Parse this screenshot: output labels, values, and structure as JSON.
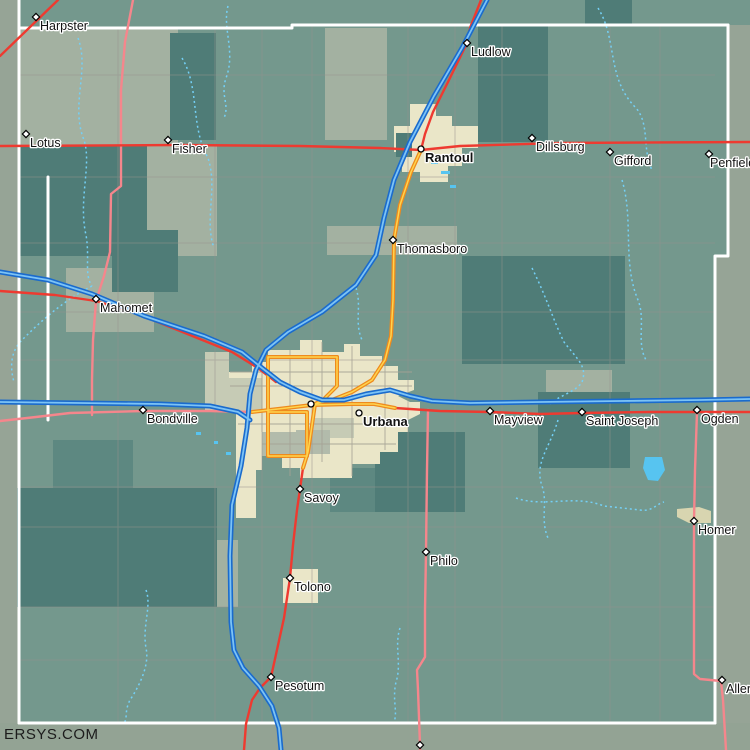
{
  "canvas": {
    "w": 750,
    "h": 750
  },
  "watermark": "ERSYS.COM",
  "palette": {
    "base": "#74988d",
    "dark": "#4f7c77",
    "mediumDark": "#5d8881",
    "light": "#a3b1a1",
    "lighter": "#c6cbb5",
    "graypatch": "#b2bbab",
    "beige": "#eae6c8",
    "khaki": "#d8d5b0",
    "outside": "#96a496",
    "band": "#93a394",
    "water": "#57c4f0",
    "stream": "#74d0f6",
    "grid": "#97928e",
    "citygrid": "#a5a295",
    "roadWhite": "#ffffff",
    "roadPink": "#f5868c",
    "roadRed": "#ee3a30",
    "roadOrangeCasing": "#ee8a1d",
    "roadOrangeCore": "#ffd44e",
    "roadBlueCasing": "#1a6bcd",
    "roadBlueCore": "#7cc3f5",
    "labelFill": "#121212",
    "labelHalo": "#ffffff"
  },
  "regions": [
    {
      "x": 0,
      "y": 0,
      "w": 18,
      "h": 750,
      "fill": "outside"
    },
    {
      "x": 728,
      "y": 25,
      "w": 22,
      "h": 231,
      "fill": "outside"
    },
    {
      "x": 715,
      "y": 256,
      "w": 35,
      "h": 467,
      "fill": "outside"
    },
    {
      "x": 0,
      "y": 723,
      "w": 750,
      "h": 27,
      "fill": "band"
    },
    {
      "x": 18,
      "y": 28,
      "w": 160,
      "h": 118,
      "fill": "light"
    },
    {
      "x": 147,
      "y": 146,
      "w": 70,
      "h": 110,
      "fill": "light"
    },
    {
      "x": 325,
      "y": 28,
      "w": 62,
      "h": 112,
      "fill": "light"
    },
    {
      "x": 327,
      "y": 226,
      "w": 130,
      "h": 29,
      "fill": "light"
    },
    {
      "x": 66,
      "y": 268,
      "w": 88,
      "h": 64,
      "fill": "light"
    },
    {
      "x": 546,
      "y": 370,
      "w": 66,
      "h": 27,
      "fill": "light"
    },
    {
      "x": 216,
      "y": 540,
      "w": 22,
      "h": 67,
      "fill": "light"
    },
    {
      "x": 18,
      "y": 146,
      "w": 129,
      "h": 110,
      "fill": "dark"
    },
    {
      "x": 170,
      "y": 33,
      "w": 46,
      "h": 107,
      "fill": "dark"
    },
    {
      "x": 478,
      "y": 25,
      "w": 70,
      "h": 117,
      "fill": "dark"
    },
    {
      "x": 585,
      "y": 0,
      "w": 47,
      "h": 25,
      "fill": "dark"
    },
    {
      "x": 112,
      "y": 230,
      "w": 66,
      "h": 62,
      "fill": "dark"
    },
    {
      "x": 462,
      "y": 256,
      "w": 163,
      "h": 108,
      "fill": "dark"
    },
    {
      "x": 538,
      "y": 392,
      "w": 92,
      "h": 76,
      "fill": "dark"
    },
    {
      "x": 375,
      "y": 432,
      "w": 90,
      "h": 80,
      "fill": "dark"
    },
    {
      "x": 53,
      "y": 440,
      "w": 80,
      "h": 48,
      "fill": "mediumDark"
    },
    {
      "x": 330,
      "y": 468,
      "w": 45,
      "h": 44,
      "fill": "mediumDark"
    },
    {
      "x": 17,
      "y": 488,
      "w": 200,
      "h": 119,
      "fill": "dark"
    },
    {
      "d": "M 394,126 L 410,126 L 410,104 L 436,104 L 436,116 L 452,116 L 452,126 L 478,126 L 478,148 L 462,148 L 462,166 L 448,166 L 448,182 L 420,182 L 420,172 L 402,172 L 402,152 L 394,152 Z",
      "fill": "beige"
    },
    {
      "x": 396,
      "y": 133,
      "w": 16,
      "h": 24,
      "fill": "dark"
    },
    {
      "d": "M 228,372 L 252,372 L 252,362 L 268,362 L 268,350 L 300,350 L 300,340 L 322,340 L 322,352 L 344,352 L 344,344 L 360,344 L 360,356 L 382,356 L 382,366 L 398,366 L 398,380 L 414,380 L 414,390 L 398,396 L 410,402 L 420,402 L 420,414 L 408,420 L 408,432 L 398,432 L 398,452 L 380,452 L 380,464 L 352,464 L 352,478 L 300,478 L 300,468 L 282,468 L 282,456 L 262,456 L 262,432 L 236,432 L 236,412 L 228,412 Z",
      "fill": "beige"
    },
    {
      "d": "M 236,432 L 262,432 L 262,470 L 256,470 L 256,518 L 236,518 Z",
      "fill": "beige"
    },
    {
      "d": "M 283,578 L 290,578 L 290,569 L 318,569 L 318,603 L 283,603 Z",
      "fill": "beige"
    },
    {
      "d": "M 677,509 L 699,507 L 711,511 L 711,523 L 689,523 L 677,517 Z",
      "fill": "khaki"
    },
    {
      "x": 205,
      "y": 352,
      "w": 24,
      "h": 60,
      "fill": "lighter"
    },
    {
      "x": 228,
      "y": 378,
      "w": 34,
      "h": 34,
      "fill": "lighter"
    },
    {
      "x": 262,
      "y": 432,
      "w": 40,
      "h": 24,
      "fill": "graypatch"
    },
    {
      "x": 312,
      "y": 418,
      "w": 42,
      "h": 20,
      "fill": "lighter"
    },
    {
      "x": 296,
      "y": 430,
      "w": 34,
      "h": 24,
      "fill": "graypatch"
    }
  ],
  "grid": {
    "v": [
      118,
      215,
      262,
      312,
      408,
      455,
      502,
      610,
      660
    ],
    "h": [
      75,
      177,
      243,
      312,
      360,
      487,
      527,
      607,
      660
    ],
    "y1": 26,
    "y2": 723,
    "x1": 18,
    "x2": 715
  },
  "city_grid": [
    {
      "x1": 262,
      "y1": 360,
      "x2": 262,
      "y2": 432
    },
    {
      "x1": 290,
      "y1": 350,
      "x2": 290,
      "y2": 476
    },
    {
      "x1": 322,
      "y1": 342,
      "x2": 322,
      "y2": 462
    },
    {
      "x1": 352,
      "y1": 346,
      "x2": 352,
      "y2": 476
    },
    {
      "x1": 385,
      "y1": 358,
      "x2": 385,
      "y2": 450
    },
    {
      "x1": 230,
      "y1": 372,
      "x2": 412,
      "y2": 372
    },
    {
      "x1": 230,
      "y1": 386,
      "x2": 412,
      "y2": 386
    },
    {
      "x1": 238,
      "y1": 424,
      "x2": 404,
      "y2": 424
    },
    {
      "x1": 262,
      "y1": 444,
      "x2": 396,
      "y2": 444
    }
  ],
  "streams": [
    {
      "d": "M 78,38 C 90,70 70,105 84,140 C 92,165 78,200 86,235 C 90,258 84,275 92,286"
    },
    {
      "d": "M 92,286 C 64,300 40,322 22,340 C 10,352 10,368 14,382"
    },
    {
      "d": "M 228,6 C 222,28 236,52 226,78 C 220,96 230,104 224,118"
    },
    {
      "d": "M 182,58 C 200,88 190,126 208,158 C 218,188 204,220 214,248"
    },
    {
      "d": "M 598,8 C 618,40 606,78 636,108 C 650,124 642,150 652,170"
    },
    {
      "d": "M 622,180 C 634,220 622,262 638,300 C 646,320 636,342 646,360"
    },
    {
      "d": "M 532,268 C 546,296 554,322 564,342 C 576,358 588,366 582,382 C 576,392 558,396 550,404"
    },
    {
      "d": "M 558,420 C 550,448 534,462 542,486 C 548,502 540,520 548,538"
    },
    {
      "d": "M 516,498 C 544,508 574,494 604,506 L 640,510 C 652,512 656,504 664,502"
    },
    {
      "d": "M 146,590 C 152,606 142,626 146,648 C 150,666 138,688 130,700 C 124,712 128,718 124,723"
    },
    {
      "d": "M 400,628 C 394,646 402,664 396,682 C 392,700 398,712 394,722"
    },
    {
      "d": "M 356,288 C 362,306 354,322 362,340"
    }
  ],
  "roads": [
    {
      "id": "county-line-west",
      "kind": "white",
      "d": "M 19,0 L 19,723"
    },
    {
      "id": "county-line-north",
      "kind": "white",
      "d": "M 19,28 L 292,28 L 292,25 L 728,25"
    },
    {
      "id": "county-line-east",
      "kind": "white",
      "d": "M 728,25 L 728,256 L 715,256 L 715,723"
    },
    {
      "id": "county-line-south",
      "kind": "white",
      "d": "M 19,723 L 715,723"
    },
    {
      "id": "white-road-west",
      "kind": "white",
      "d": "M 48,177 L 48,420"
    },
    {
      "id": "pink-route-north",
      "kind": "pink",
      "d": "M 133,0 L 125,42 L 121,90 L 121,186 L 111,194 L 110,252 L 104,276 L 96,301"
    },
    {
      "id": "pink-route-mahomet-south",
      "kind": "pink",
      "d": "M 96,301 L 93,340 L 92,380 L 92,415"
    },
    {
      "id": "pink-route-bondville",
      "kind": "pink",
      "d": "M 0,421 L 36,417 L 70,413 L 143,411 L 210,411 L 252,412"
    },
    {
      "id": "pink-route-philo",
      "kind": "pink",
      "d": "M 428,410 L 427,470 L 426,552 L 425,610 L 425,657 L 417,670 L 418,690 L 420,745 L 420,750"
    },
    {
      "id": "pink-route-ogden-homer-allerton",
      "kind": "pink",
      "d": "M 697,412 L 695,470 L 694,522 L 694,674 L 700,679 L 721,681 L 723,700 L 726,750"
    },
    {
      "id": "red-route-north",
      "kind": "red",
      "d": "M 0,146 L 180,145 L 300,146 L 380,148 L 421,150 L 460,146 L 560,143 L 750,142"
    },
    {
      "id": "red-route-harpster",
      "kind": "red",
      "d": "M 0,56 L 58,0"
    },
    {
      "id": "red-route-ludlow",
      "kind": "red",
      "d": "M 481,0 L 470,28 L 467,43 L 448,82 L 433,112 L 425,134 L 421,150"
    },
    {
      "id": "red-route-mahomet",
      "kind": "red",
      "d": "M 0,291 L 55,295 L 96,301 L 135,313 L 180,331 L 232,352 L 258,368 L 276,382"
    },
    {
      "id": "red-route-east",
      "kind": "red",
      "d": "M 395,408 L 440,411 L 490,412 L 540,414 L 582,413 L 650,412 L 697,412 L 750,412"
    },
    {
      "id": "red-route-south",
      "kind": "red",
      "d": "M 303,468 L 297,510 L 293,545 L 290,578 L 284,618 L 273,668 L 271,677 L 260,688 L 252,700 L 246,724 L 244,750"
    },
    {
      "id": "orange-us-route-north",
      "kind": "orange",
      "d": "M 421,150 L 411,172 L 400,205 L 394,240 L 393,300 L 391,336 L 385,360 L 372,380 L 352,392 L 332,400 L 315,404"
    },
    {
      "id": "orange-us-route-city",
      "kind": "orange",
      "d": "M 252,412 L 278,409 L 312,405 L 352,404 L 374,404 L 395,408"
    },
    {
      "id": "orange-loop-west",
      "kind": "orange",
      "d": "M 268,357 L 268,412"
    },
    {
      "id": "orange-loop-north",
      "kind": "orange",
      "d": "M 268,357 L 337,357"
    },
    {
      "id": "orange-loop-east",
      "kind": "orange",
      "d": "M 337,357 L 337,386 L 324,399 L 315,404"
    },
    {
      "id": "orange-loop-south-box",
      "kind": "orange",
      "d": "M 268,412 L 307,412 L 307,456 L 268,456 L 268,412"
    },
    {
      "id": "orange-us-route-savoy",
      "kind": "orange",
      "d": "M 315,404 L 311,432 L 308,452 L 303,468"
    },
    {
      "id": "interstate-north-south",
      "kind": "blue",
      "d": "M 487,0 L 462,48 L 434,96 L 410,142 L 394,180 L 384,218 L 376,255 L 356,285 L 322,312 L 288,332 L 266,350 L 256,370 L 250,394 L 247,428 L 241,466 L 232,505 L 230,556 L 231,622 L 234,650 L 243,668 L 259,686 L 272,706 L 279,728 L 281,750"
    },
    {
      "id": "interstate-east-west",
      "kind": "blue",
      "d": "M 0,272 L 48,280 L 92,294 L 144,316 L 204,336 L 242,352 L 262,368 L 280,382 L 300,392 L 322,400 L 344,400 L 366,394 L 390,390 L 410,396 L 432,401 L 470,403 L 540,402 L 620,401 L 700,400 L 750,399"
    },
    {
      "id": "interstate-west-spur",
      "kind": "blue",
      "d": "M 0,402 L 80,403 L 160,404 L 210,406 L 238,412 L 250,420"
    }
  ],
  "water_rects": [
    {
      "x": 431,
      "y": 160,
      "w": 7,
      "h": 4
    },
    {
      "x": 441,
      "y": 171,
      "w": 9,
      "h": 3
    },
    {
      "x": 450,
      "y": 185,
      "w": 6,
      "h": 3
    },
    {
      "x": 196,
      "y": 432,
      "w": 5,
      "h": 3
    },
    {
      "x": 214,
      "y": 441,
      "w": 4,
      "h": 3
    },
    {
      "x": 226,
      "y": 452,
      "w": 5,
      "h": 3
    }
  ],
  "water_paths": [
    {
      "d": "M 645,457 L 662,457 L 665,470 L 658,481 L 648,480 L 643,468 Z"
    }
  ],
  "towns": [
    {
      "name": "Harpster",
      "x": 36,
      "y": 17,
      "marker": "diamond"
    },
    {
      "name": "Lotus",
      "x": 26,
      "y": 134,
      "marker": "diamond"
    },
    {
      "name": "Fisher",
      "x": 168,
      "y": 140,
      "marker": "diamond"
    },
    {
      "name": "Ludlow",
      "x": 467,
      "y": 43,
      "marker": "diamond"
    },
    {
      "name": "Rantoul",
      "x": 421,
      "y": 149,
      "marker": "circle",
      "bold": true
    },
    {
      "name": "Dillsburg",
      "x": 532,
      "y": 138,
      "marker": "diamond"
    },
    {
      "name": "Gifford",
      "x": 610,
      "y": 152,
      "marker": "diamond"
    },
    {
      "name": "Penfield",
      "x": 709,
      "y": 154,
      "marker": "diamond",
      "dx": 1
    },
    {
      "name": "Thomasboro",
      "x": 393,
      "y": 240,
      "marker": "diamond"
    },
    {
      "name": "Mahomet",
      "x": 96,
      "y": 299,
      "marker": "diamond"
    },
    {
      "name": "Bondville",
      "x": 143,
      "y": 410,
      "marker": "diamond"
    },
    {
      "name": "",
      "x": 311,
      "y": 404,
      "marker": "circle"
    },
    {
      "name": "Urbana",
      "x": 359,
      "y": 413,
      "marker": "circle",
      "bold": true
    },
    {
      "name": "Mayview",
      "x": 490,
      "y": 411,
      "marker": "diamond"
    },
    {
      "name": "Saint Joseph",
      "x": 582,
      "y": 412,
      "marker": "diamond"
    },
    {
      "name": "Ogden",
      "x": 697,
      "y": 410,
      "marker": "diamond"
    },
    {
      "name": "Savoy",
      "x": 300,
      "y": 489,
      "marker": "diamond"
    },
    {
      "name": "Philo",
      "x": 426,
      "y": 552,
      "marker": "diamond"
    },
    {
      "name": "Tolono",
      "x": 290,
      "y": 578,
      "marker": "diamond"
    },
    {
      "name": "Pesotum",
      "x": 271,
      "y": 677,
      "marker": "diamond"
    },
    {
      "name": "Homer",
      "x": 694,
      "y": 521,
      "marker": "diamond"
    },
    {
      "name": "Allerton",
      "x": 722,
      "y": 680,
      "marker": "diamond"
    },
    {
      "name": "",
      "x": 420,
      "y": 745,
      "marker": "diamond"
    }
  ]
}
